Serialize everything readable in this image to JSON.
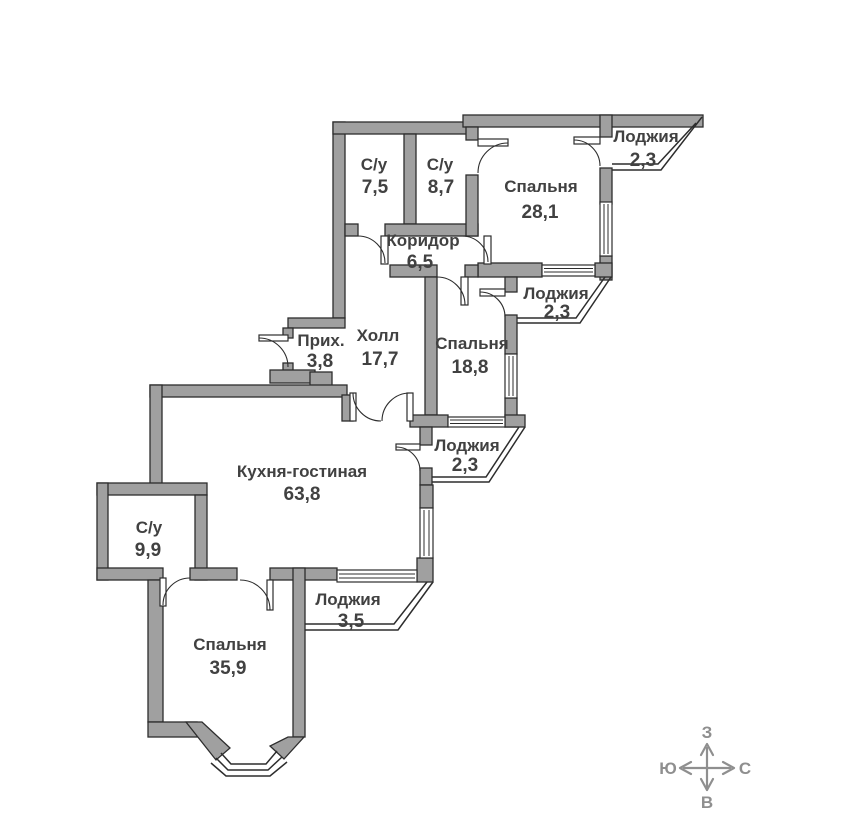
{
  "rooms": [
    {
      "name": "С/у",
      "area": "7,5"
    },
    {
      "name": "С/у",
      "area": "8,7"
    },
    {
      "name": "Спальня",
      "area": "28,1"
    },
    {
      "name": "Лоджия",
      "area": "2,3"
    },
    {
      "name": "Коридор",
      "area": "6,5"
    },
    {
      "name": "Лоджия",
      "area": "2,3"
    },
    {
      "name": "Прих.",
      "area": "3,8"
    },
    {
      "name": "Холл",
      "area": "17,7"
    },
    {
      "name": "Спальня",
      "area": "18,8"
    },
    {
      "name": "Лоджия",
      "area": "2,3"
    },
    {
      "name": "Кухня-гостиная",
      "area": "63,8"
    },
    {
      "name": "С/у",
      "area": "9,9"
    },
    {
      "name": "Лоджия",
      "area": "3,5"
    },
    {
      "name": "Спальня",
      "area": "35,9"
    }
  ],
  "compass": {
    "top": "З",
    "left": "Ю",
    "right": "С",
    "bottom": "В"
  },
  "colors": {
    "wall": "#a0a0a0",
    "outline": "#2d2d2d",
    "label": "#414141",
    "compass": "#8f8f8f",
    "window-fill": "#ffffff"
  }
}
